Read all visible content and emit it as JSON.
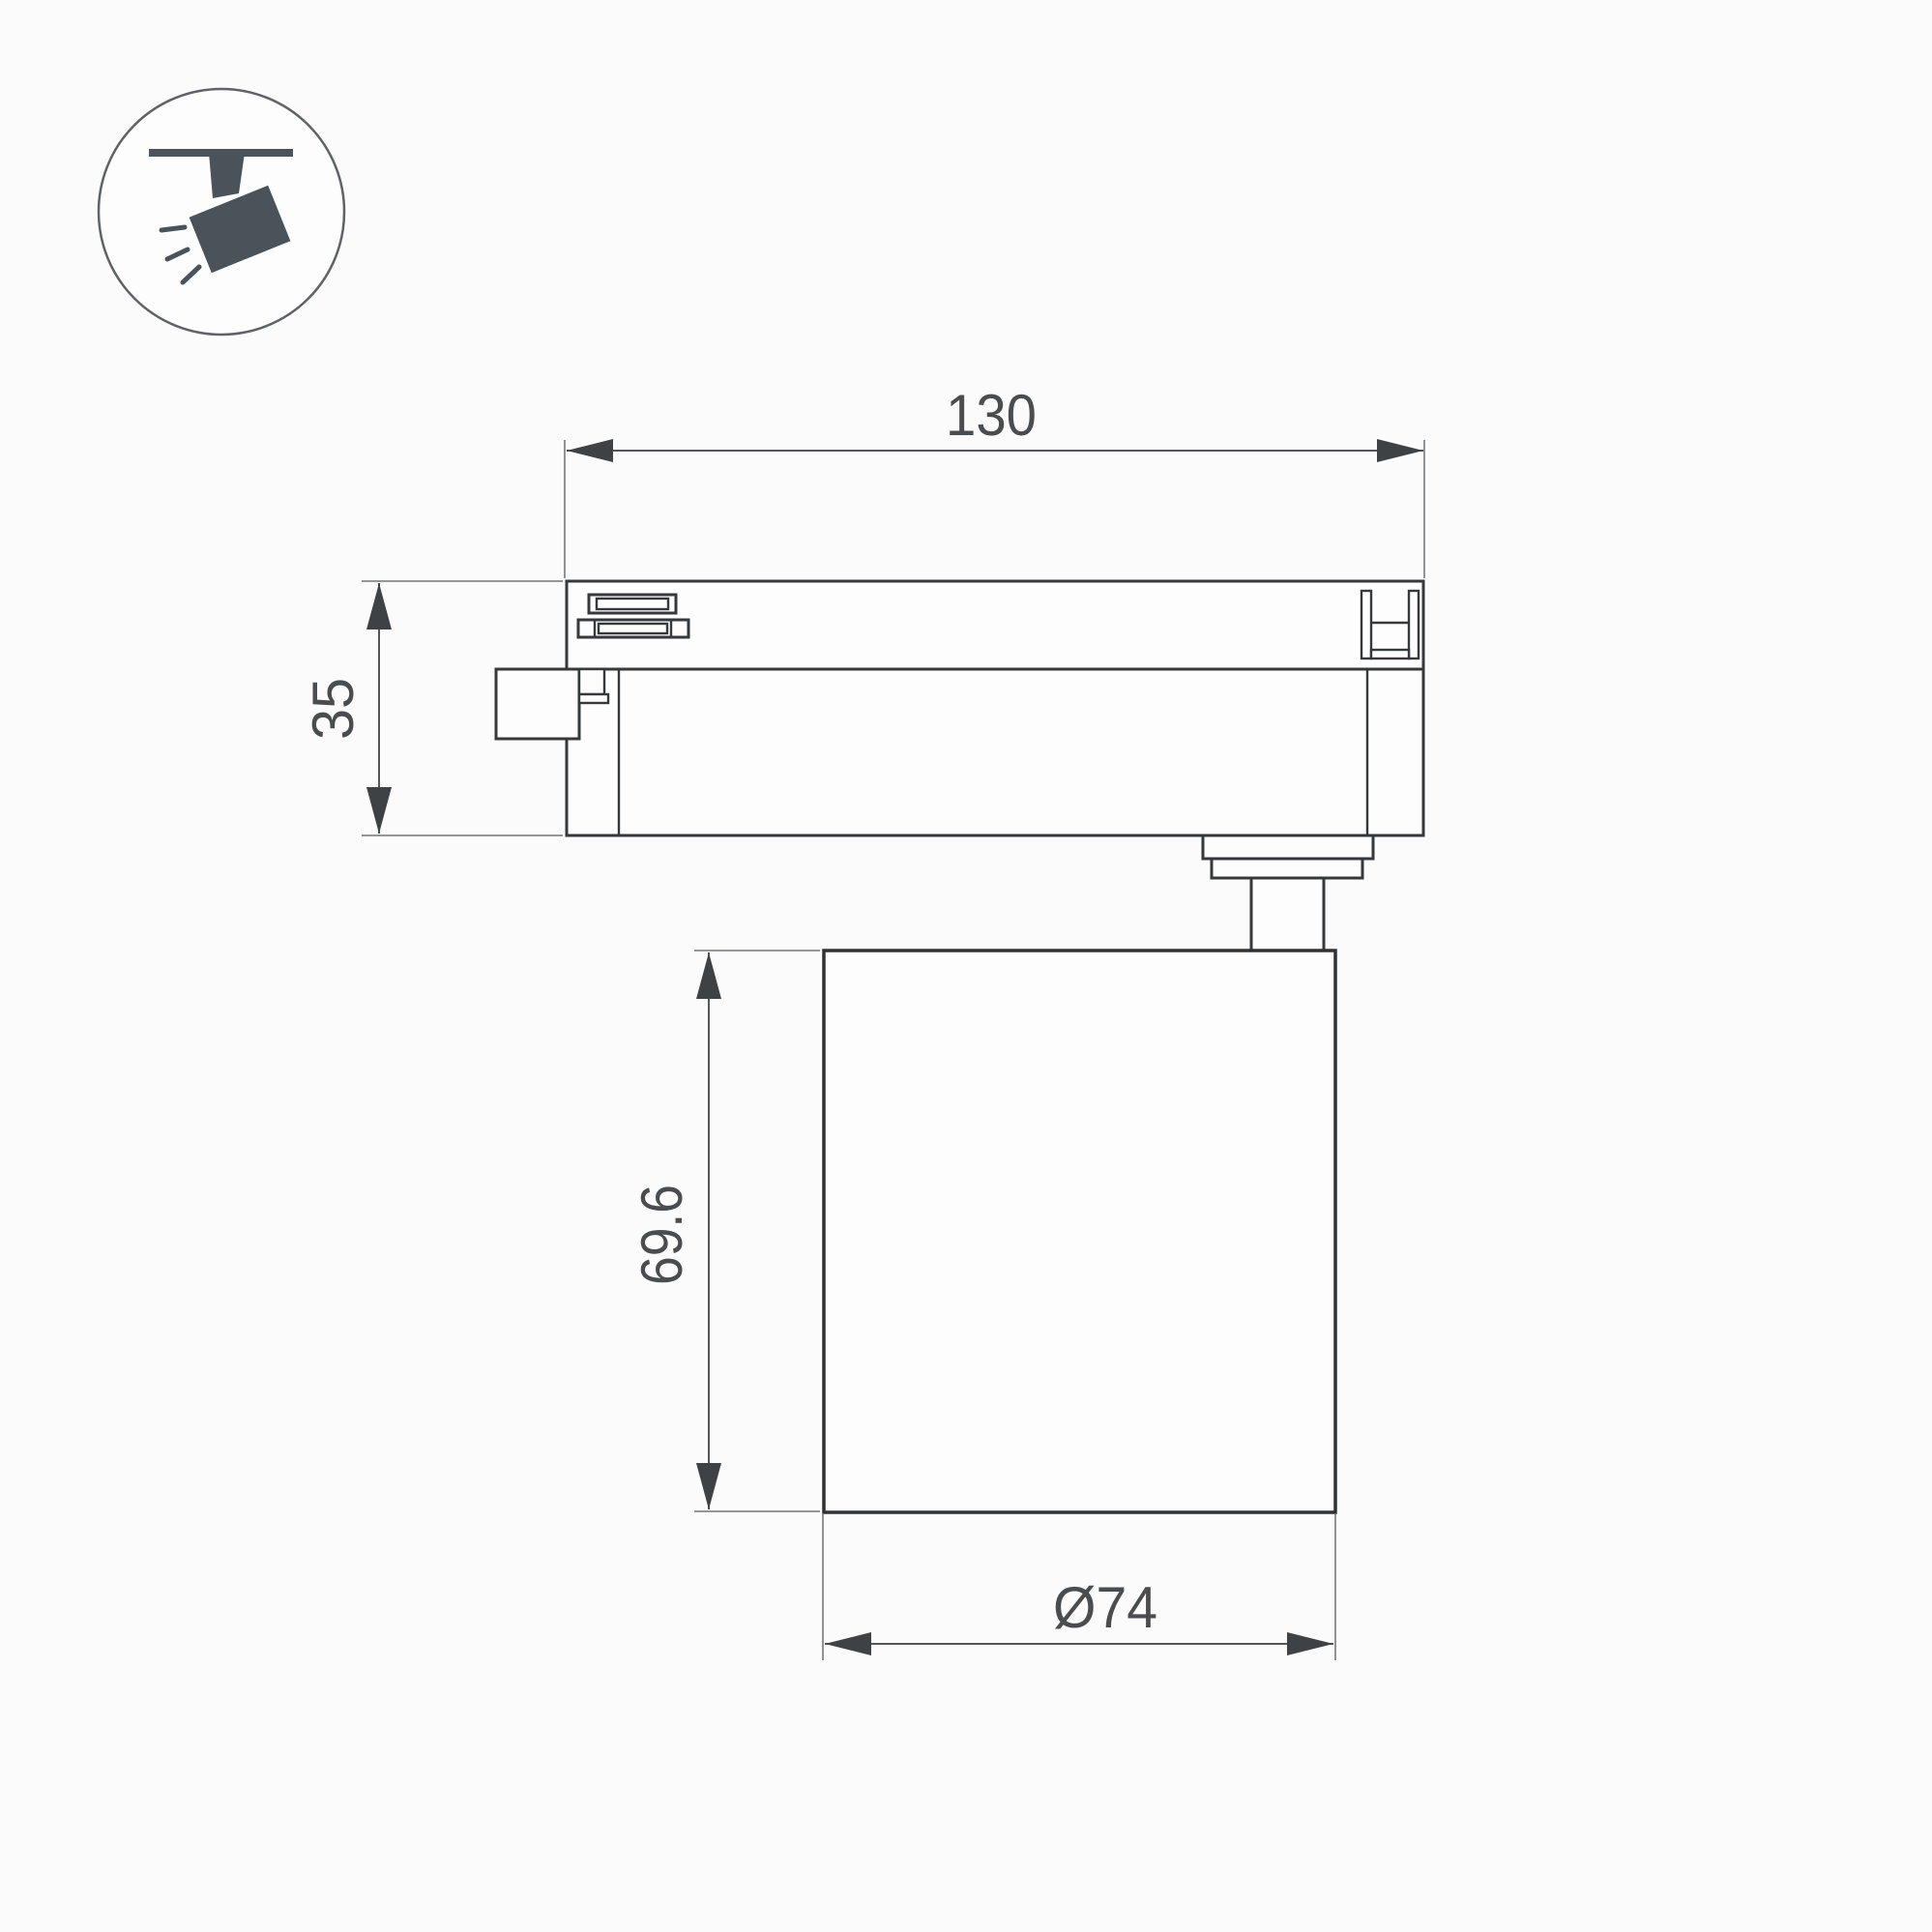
{
  "page": {
    "background_color": "#fbfbfc",
    "type_label": "technical dimension drawing of track spotlight"
  },
  "icon": {
    "meaning": "ceiling-track spotlight pictogram",
    "fill_color": "#4a525a",
    "circle_stroke_color": "#5f6367"
  },
  "drawing": {
    "outline_color": "#35393c",
    "dim_line_color": "#54575a",
    "extension_line_color": "#85888a",
    "text_color": "#4a4d4f",
    "dimensions": {
      "track_width": {
        "label": "130"
      },
      "track_height": {
        "label": "35"
      },
      "body_height": {
        "label": "69.6"
      },
      "body_diameter": {
        "label": "Ø74"
      }
    }
  }
}
